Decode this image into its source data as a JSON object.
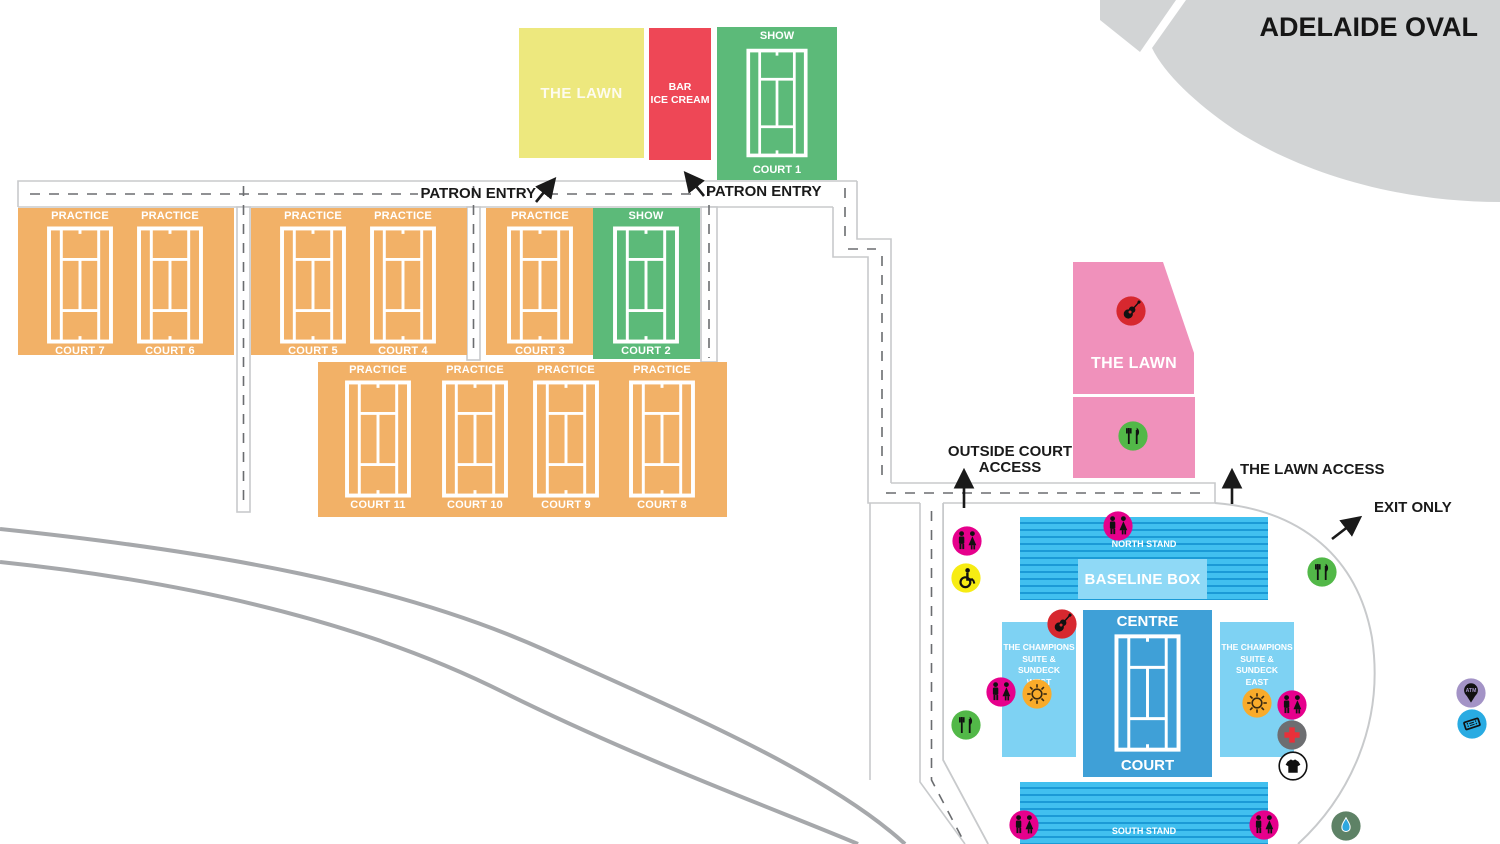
{
  "title": "ADELAIDE OVAL",
  "colors": {
    "practice_court": "#F2B167",
    "show_court": "#5CBA79",
    "lawn_yellow": "#EDE87E",
    "bar_red": "#EE4756",
    "lawn_pink": "#F091BB",
    "stand_blue": "#41C0EF",
    "stand_stripe": "#1B9AD6",
    "baseline_box_blue": "#8FD9F6",
    "suite_blue": "#7ED2F3",
    "centre_court_blue": "#3FA0D7",
    "toilets_magenta": "#E6008C",
    "accessible_yellow": "#F7EC13",
    "food_green": "#52B848",
    "music_red": "#D7282F",
    "sundeck_orange": "#F9AB2A",
    "first_aid_gray": "#6D6E71",
    "water_green": "#5E8266",
    "atm_purple": "#A393C6",
    "tickets_blue": "#29ABE2",
    "oval_gray": "#D2D4D5",
    "road_gray": "#A6A8AB"
  },
  "top_area": {
    "lawn_label": "THE LAWN",
    "bar_lines": [
      "BAR",
      "ICE CREAM"
    ],
    "show_court_1": {
      "type": "SHOW",
      "name": "COURT 1"
    }
  },
  "entries": {
    "patron_entry_left": "PATRON ENTRY",
    "patron_entry_right": "PATRON ENTRY"
  },
  "access": {
    "outside_court_lines": [
      "OUTSIDE COURT",
      "ACCESS"
    ],
    "lawn_access": "THE LAWN ACCESS",
    "exit_only": "EXIT ONLY"
  },
  "courts": [
    {
      "type": "PRACTICE",
      "name": "COURT 7"
    },
    {
      "type": "PRACTICE",
      "name": "COURT 6"
    },
    {
      "type": "PRACTICE",
      "name": "COURT 5"
    },
    {
      "type": "PRACTICE",
      "name": "COURT 4"
    },
    {
      "type": "PRACTICE",
      "name": "COURT 3"
    },
    {
      "type": "SHOW",
      "name": "COURT 2"
    },
    {
      "type": "PRACTICE",
      "name": "COURT 11"
    },
    {
      "type": "PRACTICE",
      "name": "COURT 10"
    },
    {
      "type": "PRACTICE",
      "name": "COURT 9"
    },
    {
      "type": "PRACTICE",
      "name": "COURT 8"
    }
  ],
  "lawn_area": {
    "label": "THE LAWN"
  },
  "stadium": {
    "north_stand": "NORTH STAND",
    "baseline_box": "BASELINE BOX",
    "centre_court_lines": [
      "CENTRE",
      "COURT"
    ],
    "west_suite_lines": [
      "THE CHAMPIONS",
      "SUITE & SUNDECK",
      "WEST"
    ],
    "east_suite_lines": [
      "THE CHAMPIONS",
      "SUITE & SUNDECK",
      "EAST"
    ],
    "south_stand": "SOUTH STAND"
  },
  "icons": {
    "atm_label": "ATM"
  }
}
